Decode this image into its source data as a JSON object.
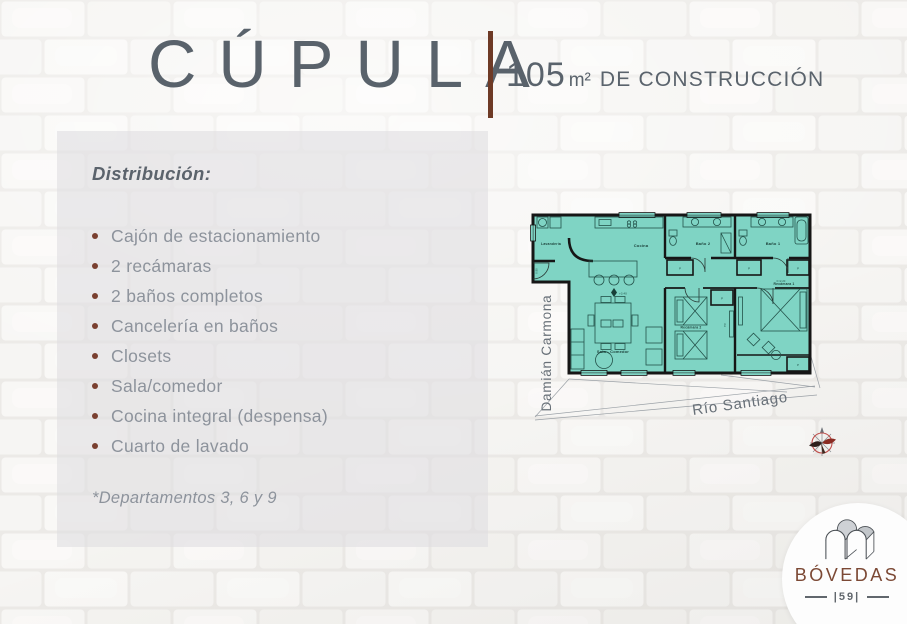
{
  "header": {
    "title": "CÚPULA",
    "area_value": "105",
    "area_unit": "m²",
    "area_label": "DE CONSTRUCCIÓN"
  },
  "panel": {
    "heading": "Distribución:",
    "items": [
      "Cajón de estacionamiento",
      "2 recámaras",
      "2 baños completos",
      "Cancelería en baños",
      "Closets",
      "Sala/comedor",
      "Cocina integral (despensa)",
      "Cuarto de lavado"
    ],
    "footnote": "*Departamentos 3, 6 y 9"
  },
  "floor_plan": {
    "rooms": {
      "laundry": "Lavandería",
      "kitchen": "Cocina",
      "bath2": "Baño 2",
      "bath1": "Baño 1",
      "living": "Sala - Comedor",
      "bedroom2": "Recámara 2",
      "bedroom1": "Recámara 1"
    },
    "labels": {
      "tv": "TV",
      "closet": "P",
      "level": "+3.40",
      "dim_width": "0.90",
      "dim_height": "h=2.20"
    },
    "streets": {
      "vertical": "Damián Carmona",
      "diagonal": "Río Santiago"
    }
  },
  "logo": {
    "name": "BÓVEDAS",
    "number": "59"
  },
  "colors": {
    "accent_brown": "#6e3a26",
    "bullet_brown": "#7a4030",
    "title_gray": "#59626b",
    "list_gray": "#8d939c",
    "plan_teal": "#7fd4c4",
    "compass_red": "#c0504d",
    "logo_brown": "#7c4935"
  }
}
